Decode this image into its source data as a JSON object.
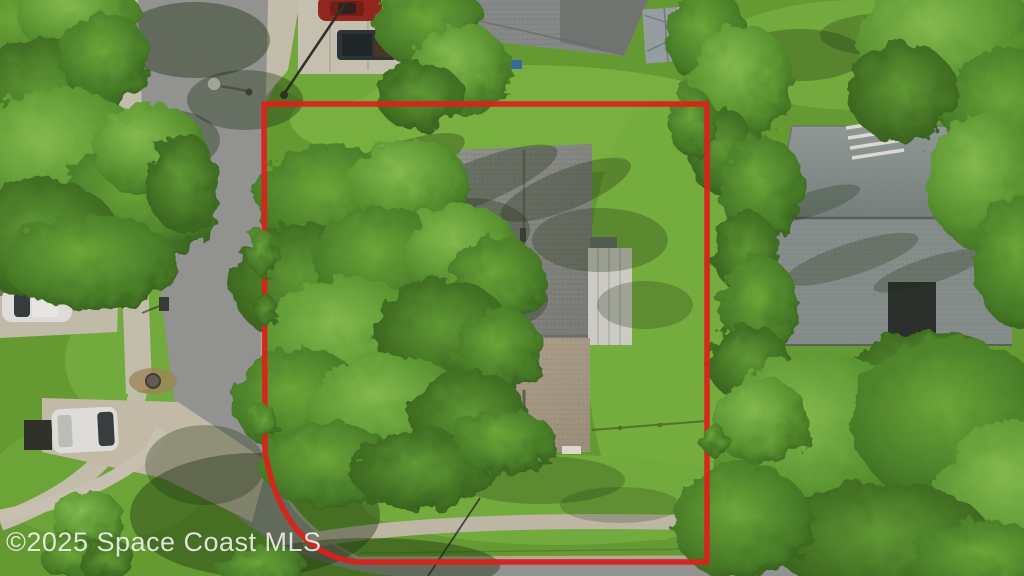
{
  "watermark": {
    "text": "©2025 Space Coast MLS"
  },
  "scene": {
    "description": "Aerial drone photo of a corner residential lot outlined with a red property boundary; large oak trees cover the center house, streets on the left and bottom, neighboring houses above and to the right",
    "colors": {
      "boundary": "#e8251c",
      "grass_base": "#6ca436",
      "grass_light": "#86c04a",
      "grass_shadow": "#3c611e",
      "road": "#9c9c9a",
      "concrete": "#d2cbba",
      "asphalt_old": "#5b5850",
      "roof_main_gray": "#90908c",
      "roof_main_tan": "#b4a58f",
      "roof_porch_white": "#d8d7d0",
      "roof_neighbor_top": "#8f9290",
      "roof_shed": "#a0a7aa",
      "roof_right_house": "#8e9794",
      "carport_dark": "#2f3430",
      "tree_light": "#8cc653",
      "tree_mid": "#5f9c33",
      "tree_dark": "#33571a",
      "car_red": "#9b2a21",
      "truck_dark": "#30383a",
      "vehicle_white": "#eceae6",
      "watermark_text": "#ffffff"
    },
    "objects": [
      "red property boundary outline",
      "center house roof under oak canopy",
      "screened porch roof",
      "neighbor house roof (top)",
      "storage shed (top)",
      "neighbor house roof (right)",
      "street along left with curve to bottom street",
      "sidewalks and driveways",
      "red car",
      "dark pickup truck",
      "white car",
      "white van",
      "streetlight",
      "manhole",
      "mailbox",
      "trash bin"
    ]
  }
}
